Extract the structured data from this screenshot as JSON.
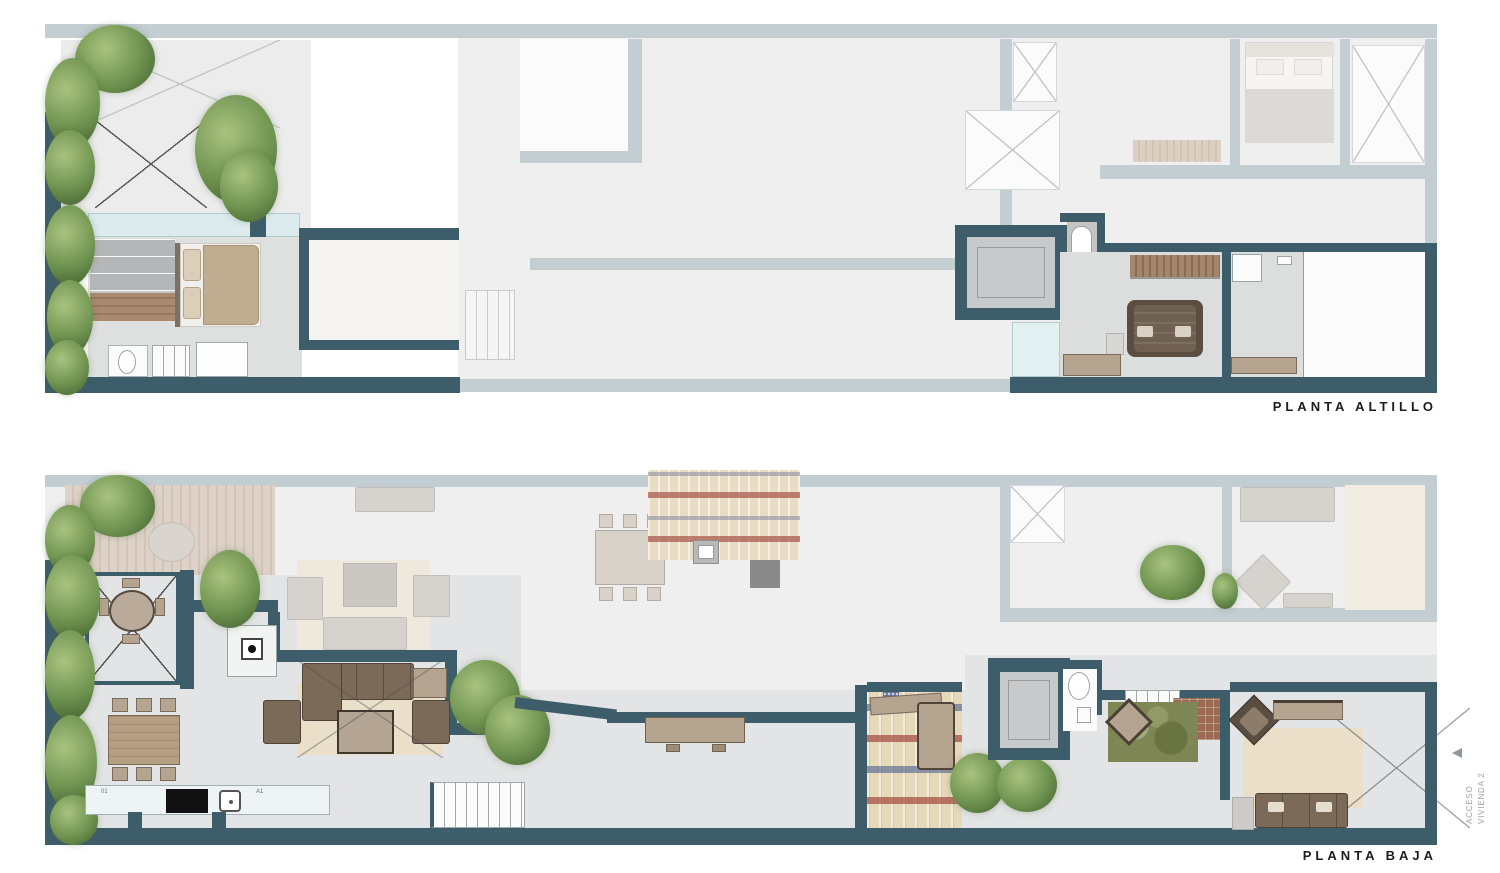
{
  "page": {
    "background": "#ffffff"
  },
  "plans": {
    "altillo": {
      "label": "PLANTA ALTILLO"
    },
    "baja": {
      "label": "PLANTA BAJA"
    }
  },
  "side_note": {
    "lines": [
      "ACCESO",
      "VIVIENDA 2"
    ],
    "arrow": "left"
  },
  "annotations": {
    "kitchen_left": "01",
    "kitchen_right": "A1"
  },
  "colors": {
    "wall": "#3d5d6a",
    "wallFaded": "#c3ced2",
    "floor": "#e3e4e5",
    "floorFaded": "#efefef",
    "glass": "#dcecee",
    "deckA": "#c0a68f",
    "deckB": "#ad917a",
    "fdeckA": "#ded2c8",
    "fdeckB": "#d2c4b8",
    "deckDarkA": "#a3806a",
    "deckDarkB": "#8f6d57",
    "vegLight": "#a9c37f",
    "veg": "#6f9350",
    "vegDark": "#42602f",
    "furnTan": "#b5a48f",
    "furnBrown": "#7b6a58",
    "furnDark": "#5a4e42",
    "furnFaded": "#d6d3cf",
    "bedTan": "#c0ac8f",
    "rugBeige": "#eadfc8",
    "rugGreen": "#7e8656",
    "tileCream": "#e6d9ba",
    "tileRed": "#a85648",
    "tileBlue": "#5c6c94",
    "elevGray": "#c8c9ca",
    "lineDark": "#4d4d4d",
    "lineFaded": "#c6c6c6",
    "labelColor": "#1d1d1d",
    "noteColor": "#96a1a4"
  }
}
